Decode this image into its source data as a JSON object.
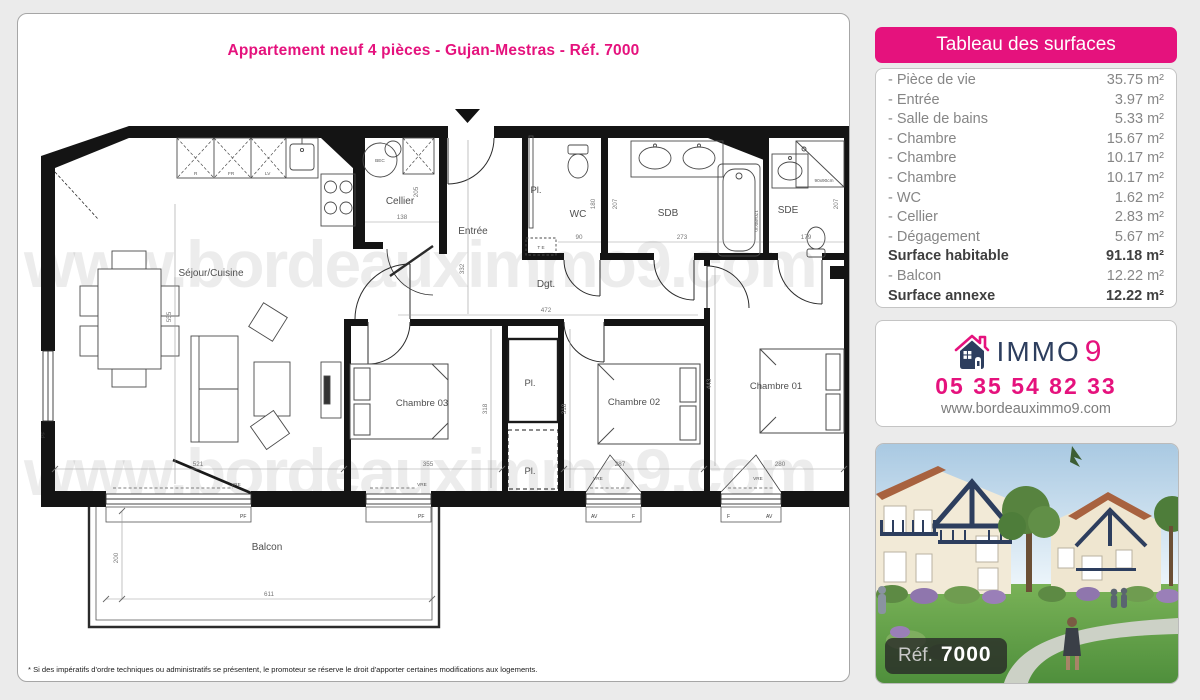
{
  "colors": {
    "accent": "#e5127d",
    "navy": "#2d3e5e"
  },
  "page": {
    "title": "Appartement neuf 4 pièces - Gujan-Mestras - Réf. 7000",
    "disclaimer": "* Si des impératifs d'ordre techniques ou administratifs se présentent, le promoteur se réserve le droit d'apporter certaines modifications aux logements.",
    "watermark": "www.bordeauximmo9.com"
  },
  "surfaces_panel": {
    "header": "Tableau des surfaces",
    "rows": [
      {
        "label": "- Pièce de vie",
        "value": "35.75 m²",
        "bold": false
      },
      {
        "label": "- Entrée",
        "value": "3.97 m²",
        "bold": false
      },
      {
        "label": "- Salle de bains",
        "value": "5.33 m²",
        "bold": false
      },
      {
        "label": "- Chambre",
        "value": "15.67 m²",
        "bold": false
      },
      {
        "label": "- Chambre",
        "value": "10.17 m²",
        "bold": false
      },
      {
        "label": "- Chambre",
        "value": "10.17 m²",
        "bold": false
      },
      {
        "label": "- WC",
        "value": "1.62 m²",
        "bold": false
      },
      {
        "label": "- Cellier",
        "value": "2.83 m²",
        "bold": false
      },
      {
        "label": "- Dégagement",
        "value": "5.67 m²",
        "bold": false
      },
      {
        "label": "Surface habitable",
        "value": "91.18 m²",
        "bold": true
      },
      {
        "label": "- Balcon",
        "value": "12.22 m²",
        "bold": false
      },
      {
        "label": "Surface annexe",
        "value": "12.22 m²",
        "bold": true
      }
    ]
  },
  "agency": {
    "brand_immo": "IMMO",
    "brand_9": "9",
    "phone": "05 35 54 82 33",
    "website": "www.bordeauximmo9.com"
  },
  "photo": {
    "ref_label": "Réf.",
    "ref_value": "7000"
  },
  "plan": {
    "rooms": {
      "sejour": "Séjour/Cuisine",
      "cellier": "Cellier",
      "entree": "Entrée",
      "pl_entree": "Pl.",
      "wc": "WC",
      "sdb": "SDB",
      "sde": "SDE",
      "dgt": "Dgt.",
      "ch03": "Chambre 03",
      "ch02": "Chambre 02",
      "ch01": "Chambre 01",
      "pl_upper": "Pl.",
      "pl_lower": "Pl.",
      "balcon": "Balcon"
    },
    "dims": {
      "d555": "555",
      "d521": "521",
      "d138": "138",
      "d205": "205",
      "d332": "332",
      "d90": "90",
      "d180": "180",
      "d207_sdb": "207",
      "d273": "273",
      "d179": "179",
      "d207_sde": "207",
      "d472": "472",
      "d355": "355",
      "d318_a": "318",
      "d318_b": "318",
      "d287": "287",
      "d443": "443",
      "d280": "280",
      "d200": "200",
      "d611": "611"
    },
    "annotations": {
      "bec": "BEC",
      "te": "T E",
      "r": "R",
      "fr": "FR",
      "lv": "LV",
      "bath": "170x80cm",
      "shower": "90x90cm"
    },
    "windows": {
      "sejour_top": "VRE",
      "sejour_tab": "PF",
      "ch03_top": "VRE",
      "ch03_tab": "PF",
      "ch02_top": "VRE",
      "ch02_tab_l": "AV",
      "ch02_tab_r": "F",
      "ch01_top": "VRE",
      "ch01_tab_l": "F",
      "ch01_tab_r": "AV",
      "left_tab": "PF"
    }
  }
}
